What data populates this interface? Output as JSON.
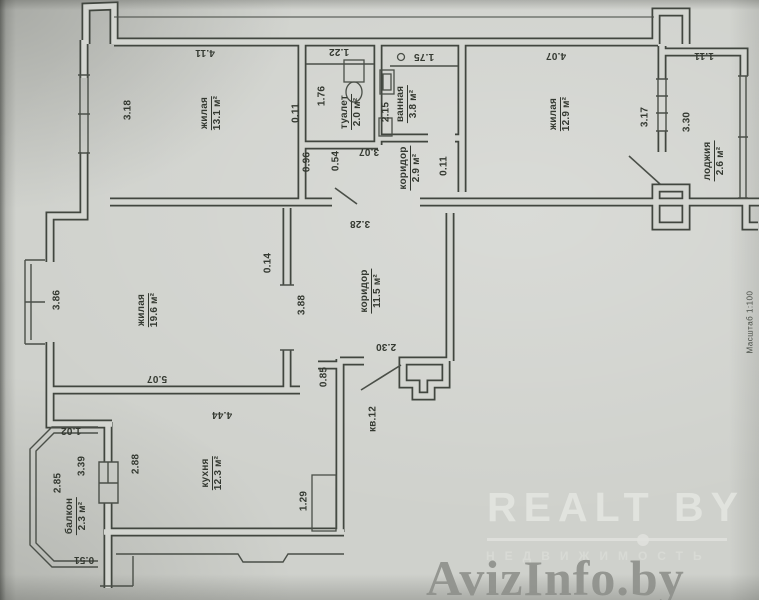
{
  "document": {
    "scale_note": "Масштаб 1:100",
    "apartment_label": "кв.12"
  },
  "colors": {
    "paper": "#cfd1cc",
    "ink": "#41463f",
    "watermark_light": "#e4e6e1",
    "watermark_gray": "#8d8f8a"
  },
  "rooms": {
    "living1": {
      "name": "жилая",
      "area": "13.1 м²"
    },
    "toilet": {
      "name": "туалет",
      "area": "2.0 м²"
    },
    "bath": {
      "name": "ванная",
      "area": "3.8 м²"
    },
    "hall_small": {
      "name": "коридор",
      "area": "2.9 м²"
    },
    "living2": {
      "name": "жилая",
      "area": "12.9 м²"
    },
    "loggia": {
      "name": "лоджия",
      "area": "2.6 м²"
    },
    "hall": {
      "name": "коридор",
      "area": "11.5 м²"
    },
    "living3": {
      "name": "жилая",
      "area": "19.6 м²"
    },
    "kitchen": {
      "name": "кухня",
      "area": "12.3 м²"
    },
    "balcony": {
      "name": "балкон",
      "area": "2.3 м²"
    }
  },
  "dims": [
    "4.11",
    "1.22",
    "1.75",
    "4.07",
    "1.11",
    "3.18",
    "1.76",
    "0.11",
    "2.15",
    "3.17",
    "3.30",
    "0.96",
    "0.54",
    "3.07",
    "0.11",
    "3.28",
    "0.14",
    "3.88",
    "3.86",
    "5.07",
    "2.30",
    "0.85",
    "4.44",
    "1.02",
    "2.88",
    "3.39",
    "2.85",
    "1.29",
    "0.51"
  ],
  "watermarks": {
    "brand": "REALT BY",
    "brand_sub": "НЕДВИЖИМОСТЬ",
    "portal": "AvizInfo.by"
  }
}
